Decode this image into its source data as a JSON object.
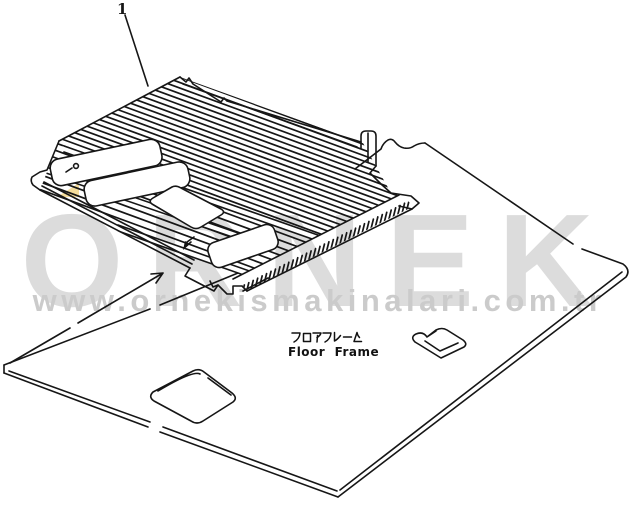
{
  "page": {
    "background_color": "#ffffff",
    "line_color": "#161616",
    "description": "Scanned isometric parts diagram: slatted floor frame assembly above a large floor plate"
  },
  "callout": {
    "number": "1"
  },
  "part_label": {
    "japanese": "フロアフレーム",
    "english": "Floor  Frame"
  },
  "watermark": {
    "brand": "ORNEK",
    "website": "www.ornekismakinalari.com.tr",
    "brand_color": "#dcdcdc",
    "website_color": "#cbcbcb",
    "triangle_color": "#f5dd9b"
  }
}
